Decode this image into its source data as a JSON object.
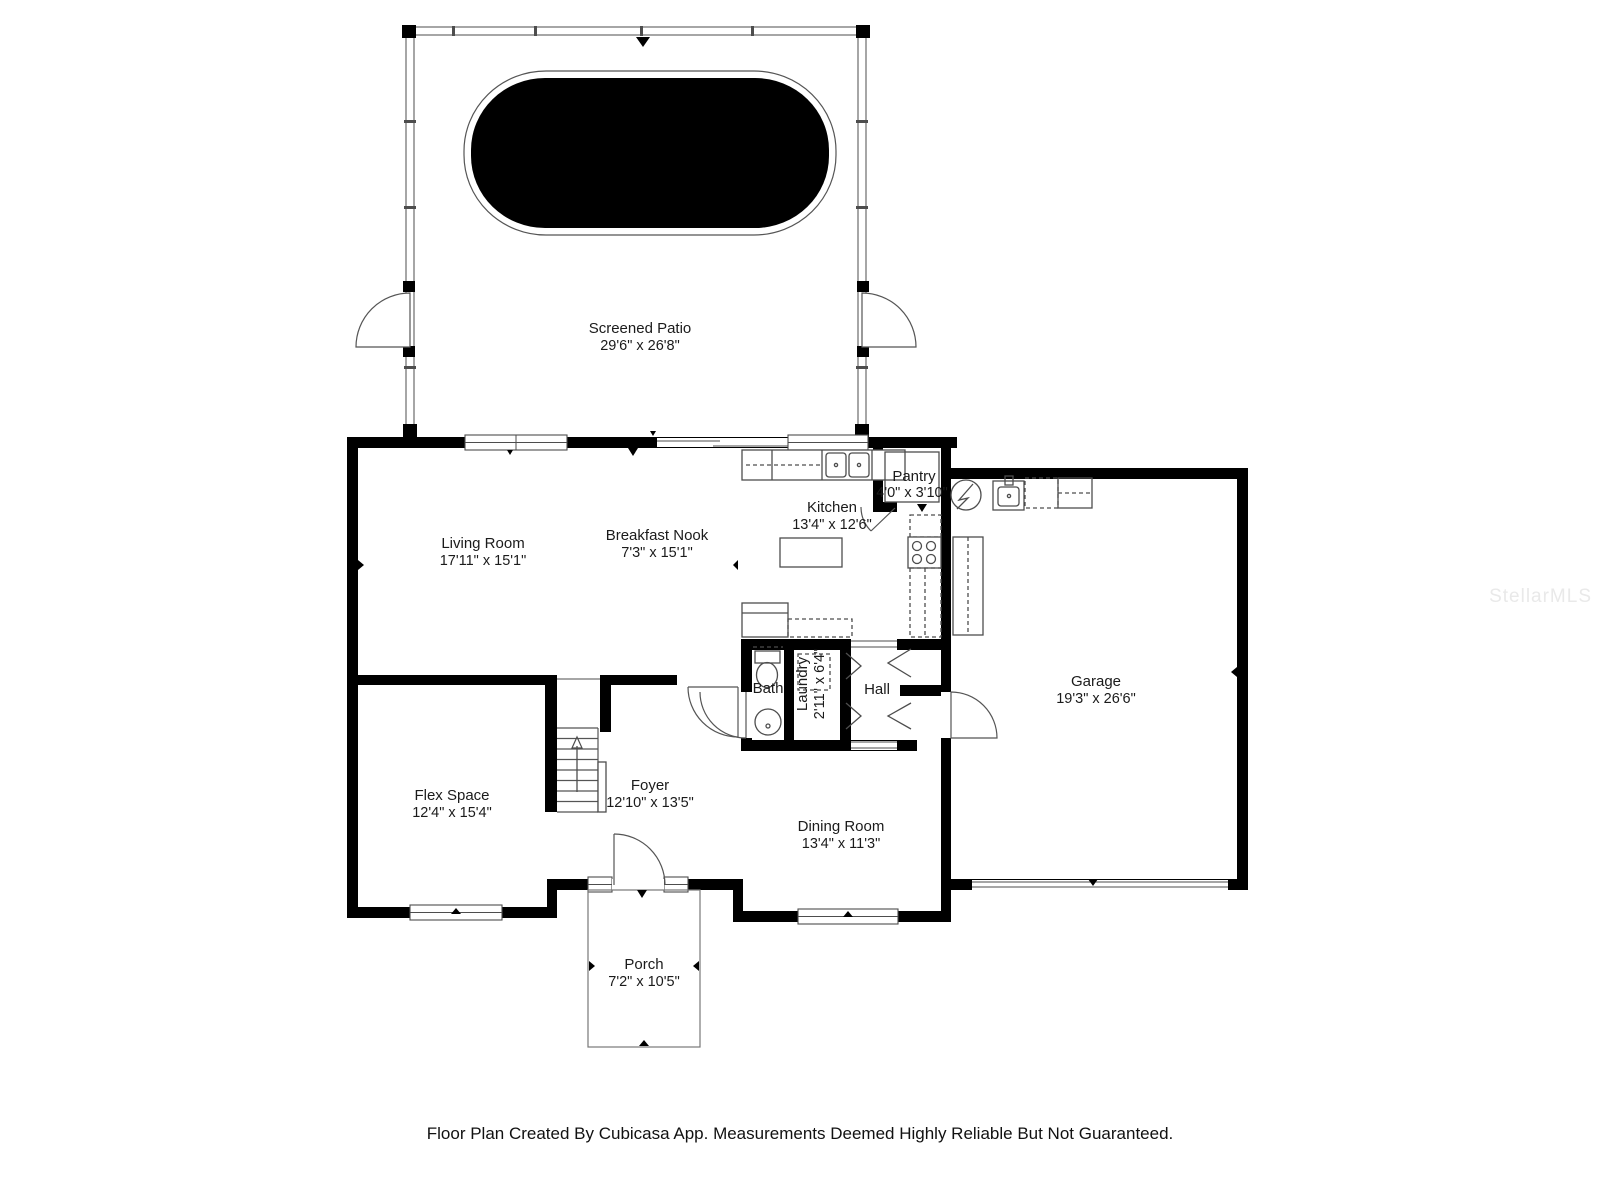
{
  "colors": {
    "wall": "#000000",
    "fixture": "#4d4d4d",
    "pool": "#000000",
    "label": "#1b1b1b",
    "watermark": "#e9e9e9"
  },
  "watermark": "StellarMLS",
  "footer": "Floor Plan Created By Cubicasa App. Measurements Deemed Highly Reliable But Not Guaranteed.",
  "rooms": {
    "screened_patio": {
      "name": "Screened Patio",
      "dims": "29'6\" x 26'8\""
    },
    "living_room": {
      "name": "Living Room",
      "dims": "17'11\" x 15'1\""
    },
    "breakfast_nook": {
      "name": "Breakfast Nook",
      "dims": "7'3\" x 15'1\""
    },
    "kitchen": {
      "name": "Kitchen",
      "dims": "13'4\" x 12'6\""
    },
    "pantry": {
      "name": "Pantry",
      "dims": "4'0\" x 3'10\""
    },
    "garage": {
      "name": "Garage",
      "dims": "19'3\" x 26'6\""
    },
    "bath": {
      "name": "Bath"
    },
    "laundry": {
      "name": "Laundry",
      "dims": "2'11\" x 6'4\""
    },
    "hall": {
      "name": "Hall"
    },
    "flex_space": {
      "name": "Flex Space",
      "dims": "12'4\" x 15'4\""
    },
    "foyer": {
      "name": "Foyer",
      "dims": "12'10\" x 13'5\""
    },
    "dining_room": {
      "name": "Dining Room",
      "dims": "13'4\" x 11'3\""
    },
    "porch": {
      "name": "Porch",
      "dims": "7'2\" x 10'5\""
    }
  }
}
